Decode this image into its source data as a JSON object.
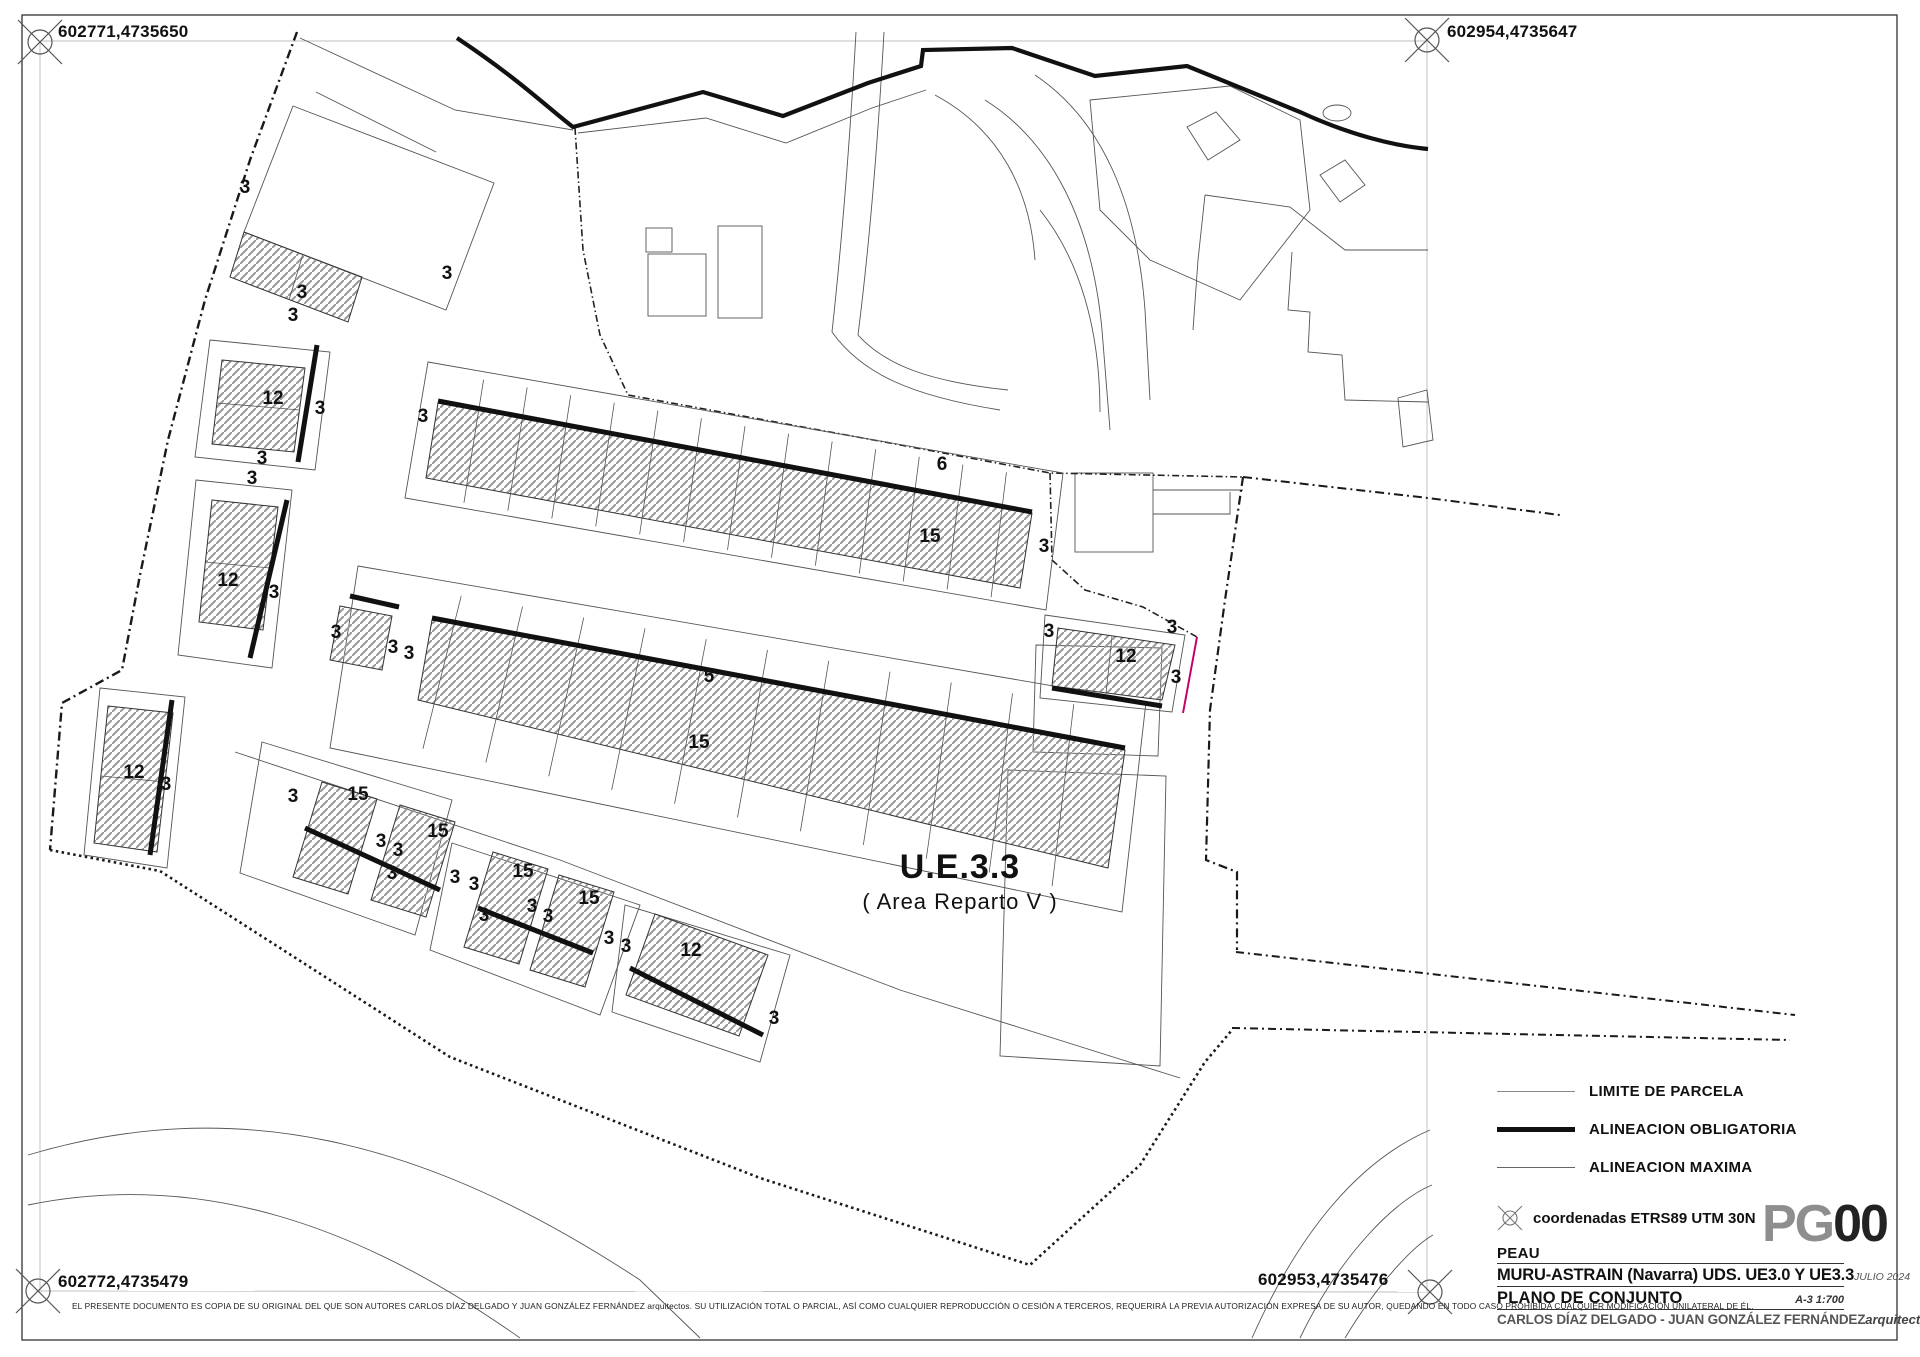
{
  "corners": {
    "top_left": "602771,4735650",
    "top_right": "602954,4735647",
    "bottom_left": "602772,4735479",
    "bottom_right": "602953,4735476"
  },
  "area_label": {
    "title": "U.E.3.3",
    "subtitle": "( Area Reparto V )"
  },
  "legend": {
    "items": [
      {
        "label": "LIMITE DE PARCELA",
        "style": "thin"
      },
      {
        "label": "ALINEACION OBLIGATORIA",
        "style": "thick"
      },
      {
        "label": "ALINEACION MAXIMA",
        "style": "medium"
      }
    ],
    "coords_note": "coordenadas ETRS89 UTM 30N"
  },
  "sheet_code": {
    "prefix": "PG",
    "number": "00"
  },
  "title_block": {
    "project": "PEAU",
    "location": "MURU-ASTRAIN (Navarra) UDS. UE3.0 Y UE3.3",
    "date": "JULIO 2024",
    "sheet_title": "PLANO DE CONJUNTO",
    "format_scale": "A-3 1:700",
    "authors": "CARLOS DÍAZ DELGADO - JUAN GONZÁLEZ FERNÁNDEZ",
    "profession": "arquitectos"
  },
  "disclaimer": "EL PRESENTE DOCUMENTO ES COPIA DE SU ORIGINAL DEL QUE SON AUTORES CARLOS DÍAZ DELGADO Y JUAN GONZÁLEZ FERNÁNDEZ arquitectos. SU UTILIZACIÓN TOTAL O PARCIAL, ASÍ COMO CUALQUIER REPRODUCCIÓN O CESIÓN A TERCEROS, REQUERIRÁ LA PREVIA AUTORIZACIÓN EXPRESA DE SU AUTOR, QUEDANDO EN TODO CASO PROHIBIDA CUALQUIER MODIFICACIÓN UNILATERAL DE ÉL.",
  "colors": {
    "alignment_obligatory": "#111111",
    "parcel_line": "#555555",
    "boundary": "#1a1a1a",
    "hatch": "#979797",
    "max_alignment_magenta": "#c4006a"
  },
  "dimension_labels": [
    {
      "t": "3",
      "x": 245,
      "y": 193
    },
    {
      "t": "3",
      "x": 447,
      "y": 279
    },
    {
      "t": "3",
      "x": 302,
      "y": 298
    },
    {
      "t": "3",
      "x": 293,
      "y": 321
    },
    {
      "t": "12",
      "x": 273,
      "y": 404
    },
    {
      "t": "3",
      "x": 320,
      "y": 414
    },
    {
      "t": "3",
      "x": 262,
      "y": 464
    },
    {
      "t": "3",
      "x": 252,
      "y": 484
    },
    {
      "t": "12",
      "x": 228,
      "y": 586
    },
    {
      "t": "3",
      "x": 274,
      "y": 598
    },
    {
      "t": "12",
      "x": 134,
      "y": 778
    },
    {
      "t": "3",
      "x": 166,
      "y": 790
    },
    {
      "t": "3",
      "x": 423,
      "y": 422
    },
    {
      "t": "6",
      "x": 942,
      "y": 470
    },
    {
      "t": "15",
      "x": 930,
      "y": 542
    },
    {
      "t": "3",
      "x": 1044,
      "y": 552
    },
    {
      "t": "3",
      "x": 336,
      "y": 638
    },
    {
      "t": "3",
      "x": 393,
      "y": 653
    },
    {
      "t": "3",
      "x": 409,
      "y": 659
    },
    {
      "t": "5",
      "x": 709,
      "y": 682
    },
    {
      "t": "15",
      "x": 699,
      "y": 748
    },
    {
      "t": "3",
      "x": 1049,
      "y": 637
    },
    {
      "t": "3",
      "x": 1172,
      "y": 633
    },
    {
      "t": "12",
      "x": 1126,
      "y": 662
    },
    {
      "t": "3",
      "x": 1176,
      "y": 683
    },
    {
      "t": "3",
      "x": 293,
      "y": 802
    },
    {
      "t": "15",
      "x": 358,
      "y": 800
    },
    {
      "t": "3",
      "x": 381,
      "y": 847
    },
    {
      "t": "3",
      "x": 398,
      "y": 856
    },
    {
      "t": "15",
      "x": 438,
      "y": 837
    },
    {
      "t": "3",
      "x": 392,
      "y": 879
    },
    {
      "t": "3",
      "x": 455,
      "y": 883
    },
    {
      "t": "3",
      "x": 474,
      "y": 890
    },
    {
      "t": "15",
      "x": 523,
      "y": 877
    },
    {
      "t": "3",
      "x": 532,
      "y": 912
    },
    {
      "t": "3",
      "x": 548,
      "y": 922
    },
    {
      "t": "15",
      "x": 589,
      "y": 904
    },
    {
      "t": "3",
      "x": 484,
      "y": 921
    },
    {
      "t": "3",
      "x": 609,
      "y": 944
    },
    {
      "t": "3",
      "x": 626,
      "y": 952
    },
    {
      "t": "12",
      "x": 691,
      "y": 956
    },
    {
      "t": "3",
      "x": 774,
      "y": 1024
    }
  ]
}
